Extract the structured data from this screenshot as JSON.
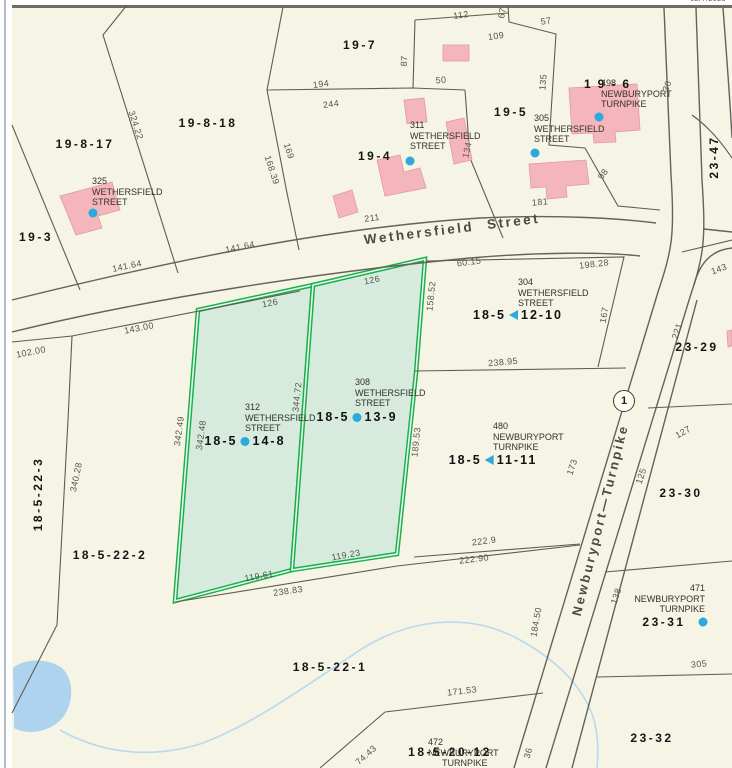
{
  "meta": {
    "date_stamp": "02/7/2025"
  },
  "streets": {
    "wethersfield": "Wethersfield Street",
    "turnpike": "Newburyport—Turnpike",
    "route_shield": "1"
  },
  "parcels": [
    "19-8-17",
    "19-8-18",
    "19-7",
    "19-5",
    "19-6",
    "19-4",
    "19-3",
    "23-47",
    "23-29",
    "23-30",
    "23-31",
    "23-32",
    "18-5-22-3",
    "18-5-22-2",
    "18-5-22-1",
    "18-5-20-12"
  ],
  "selected": [
    {
      "prefix": "18-5",
      "suffix": "14-8"
    },
    {
      "prefix": "18-5",
      "suffix": "13-9"
    },
    {
      "prefix": "18-5",
      "suffix": "12-10"
    },
    {
      "prefix": "18-5",
      "suffix": "11-11"
    }
  ],
  "addresses": [
    [
      "325",
      "WETHERSFIELD",
      "STREET"
    ],
    [
      "311",
      "WETHERSFIELD",
      "STREET"
    ],
    [
      "305",
      "WETHERSFIELD",
      "STREET"
    ],
    [
      "498",
      "NEWBURYPORT",
      "TURNPIKE"
    ],
    [
      "304",
      "WETHERSFIELD",
      "STREET"
    ],
    [
      "312",
      "WETHERSFIELD",
      "STREET"
    ],
    [
      "308",
      "WETHERSFIELD",
      "STREET"
    ],
    [
      "480",
      "NEWBURYPORT",
      "TURNPIKE"
    ],
    [
      "471",
      "NEWBURYPORT",
      "TURNPIKE"
    ],
    [
      "472",
      "NEWBURYPORT",
      "TURNPIKE"
    ]
  ],
  "dimensions": [
    "112",
    "67",
    "57",
    "109",
    "194",
    "244",
    "87",
    "50",
    "135",
    "134",
    "169",
    "168.39",
    "324.22",
    "141.64",
    "141.64",
    "211",
    "181",
    "143.00",
    "102.00",
    "60.15",
    "198.28",
    "158.52",
    "126",
    "126",
    "167",
    "238.95",
    "342.49",
    "342.48",
    "344.72",
    "340.28",
    "189.53",
    "143",
    "221",
    "127",
    "173",
    "125",
    "119.61",
    "238.83",
    "119.23",
    "222.9",
    "222.90",
    "171.53",
    "184.50",
    "74.43",
    "138",
    "305",
    "36",
    "98",
    "30"
  ],
  "colors": {
    "selection_green": "#17b04a",
    "selection_fill": "#d6ebdd",
    "building_pink": "#f4b6bb",
    "water_blue": "#aed3ee",
    "marker_blue": "#2da9de",
    "line_gray": "#5f5d50",
    "background": "#f6f4e4"
  }
}
